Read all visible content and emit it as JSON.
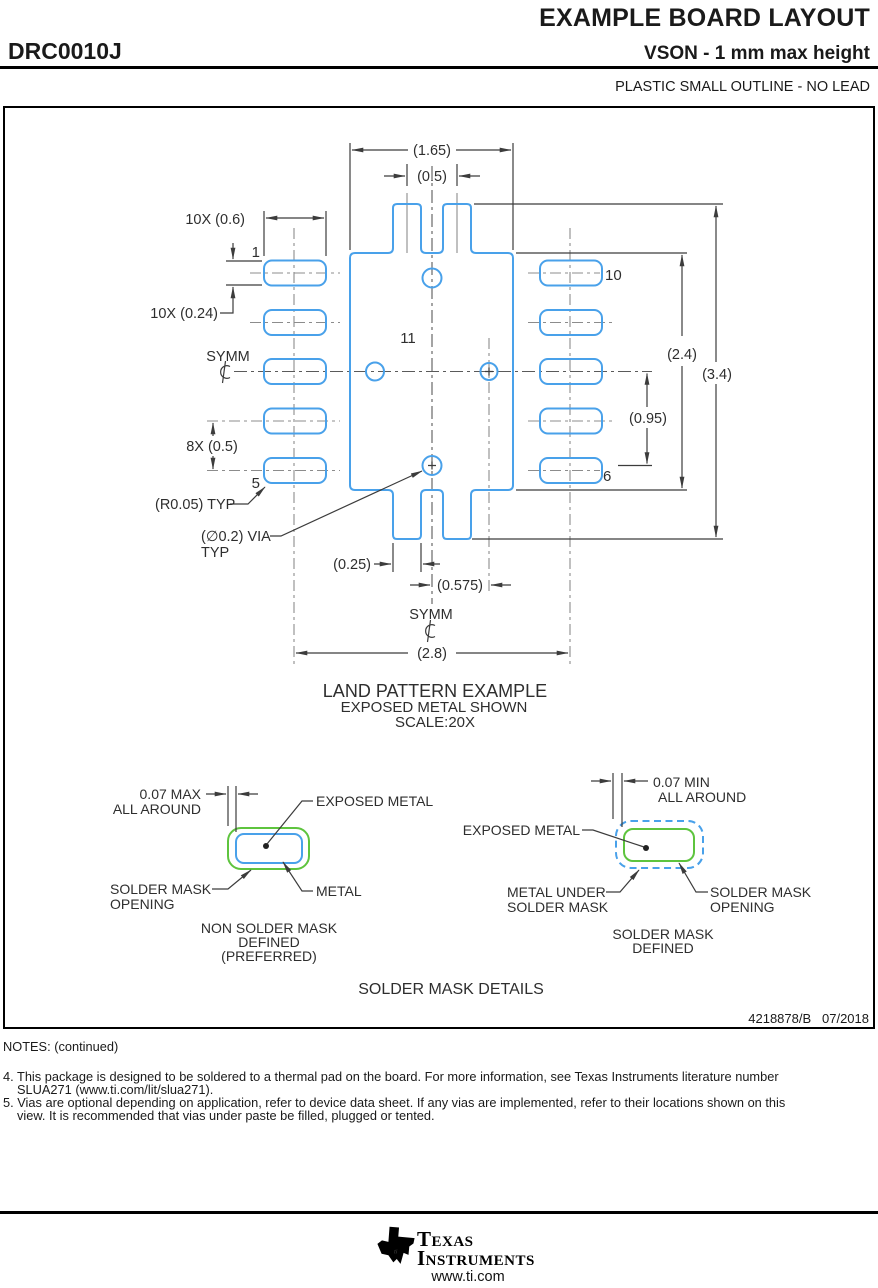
{
  "header": {
    "title": "EXAMPLE BOARD LAYOUT",
    "part_number": "DRC0010J",
    "subtitle": "VSON - 1 mm max height",
    "package_desc": "PLASTIC SMALL OUTLINE - NO LEAD"
  },
  "drawing": {
    "copper_color": "#49a1ea",
    "mask_color": "#5ec43e",
    "dims": {
      "pad_width": "(1.65)",
      "notch_pitch": "(0.5)",
      "pin_pad_w": "10X (0.6)",
      "pin_pad_h": "10X (0.24)",
      "pin_pitch": "8X (0.5)",
      "corner_radius": "(R0.05) TYP",
      "via_line1": "(∅0.2) VIA",
      "via_line2": "TYP",
      "notch_w": "(0.25)",
      "via_offset_x": "(0.575)",
      "row_span": "(2.8)",
      "pad_length": "(2.4)",
      "total_length": "(3.4)",
      "via_offset_y": "(0.95)"
    },
    "symm": "SYMM",
    "pins": {
      "p1": "1",
      "p5": "5",
      "p6": "6",
      "p10": "10",
      "p11": "11"
    },
    "captions": {
      "l1": "LAND PATTERN EXAMPLE",
      "l2": "EXPOSED METAL SHOWN",
      "l3": "SCALE:20X"
    }
  },
  "mask_details": {
    "title": "SOLDER MASK DETAILS",
    "nsmd": {
      "dim_l1": "0.07 MAX",
      "dim_l2": "ALL AROUND",
      "exposed": "EXPOSED METAL",
      "open_l1": "SOLDER MASK",
      "open_l2": "OPENING",
      "metal": "METAL",
      "cap_l1": "NON SOLDER MASK",
      "cap_l2": "DEFINED",
      "cap_l3": "(PREFERRED)"
    },
    "smd": {
      "dim_l1": "0.07 MIN",
      "dim_l2": "ALL AROUND",
      "exposed": "EXPOSED METAL",
      "under_l1": "METAL UNDER",
      "under_l2": "SOLDER MASK",
      "open_l1": "SOLDER MASK",
      "open_l2": "OPENING",
      "cap_l1": "SOLDER MASK",
      "cap_l2": "DEFINED"
    }
  },
  "doc_ref": "4218878/B   07/2018",
  "notes": {
    "heading": "NOTES: (continued)",
    "n4": "4. This package is designed to be soldered to a thermal pad on the board. For more information, see Texas Instruments literature number SLUA271 (www.ti.com/lit/slua271).",
    "n5": "5. Vias are optional depending on application, refer to device data sheet. If any vias are implemented, refer to their locations shown on this view. It is recommended that vias under paste be filled, plugged or tented."
  },
  "footer": {
    "brand_l1": "Texas",
    "brand_l2": "Instruments",
    "logo_text": "ti",
    "url": "www.ti.com"
  }
}
